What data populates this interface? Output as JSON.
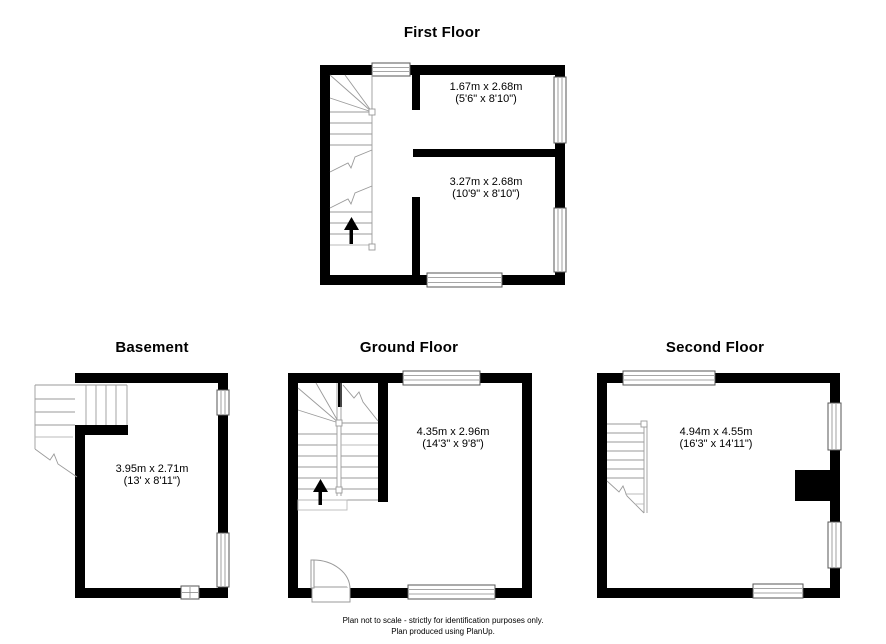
{
  "colors": {
    "background": "#ffffff",
    "wall": "#000000",
    "stair_line": "#9a9a9a",
    "window_frame": "#555555"
  },
  "floors": [
    {
      "title": "First Floor",
      "rooms": [
        {
          "metric": "1.67m x 2.68m",
          "imperial": "(5'6\" x 8'10\")"
        },
        {
          "metric": "3.27m x 2.68m",
          "imperial": "(10'9\" x 8'10\")"
        }
      ]
    },
    {
      "title": "Basement",
      "rooms": [
        {
          "metric": "3.95m x 2.71m",
          "imperial": "(13' x 8'11\")"
        }
      ]
    },
    {
      "title": "Ground Floor",
      "rooms": [
        {
          "metric": "4.35m x 2.96m",
          "imperial": "(14'3\" x 9'8\")"
        }
      ]
    },
    {
      "title": "Second Floor",
      "rooms": [
        {
          "metric": "4.94m x 4.55m",
          "imperial": "(16'3\" x 14'11\")"
        }
      ]
    }
  ],
  "footer": {
    "line1": "Plan not to scale - strictly for identification purposes only.",
    "line2": "Plan produced using PlanUp."
  }
}
